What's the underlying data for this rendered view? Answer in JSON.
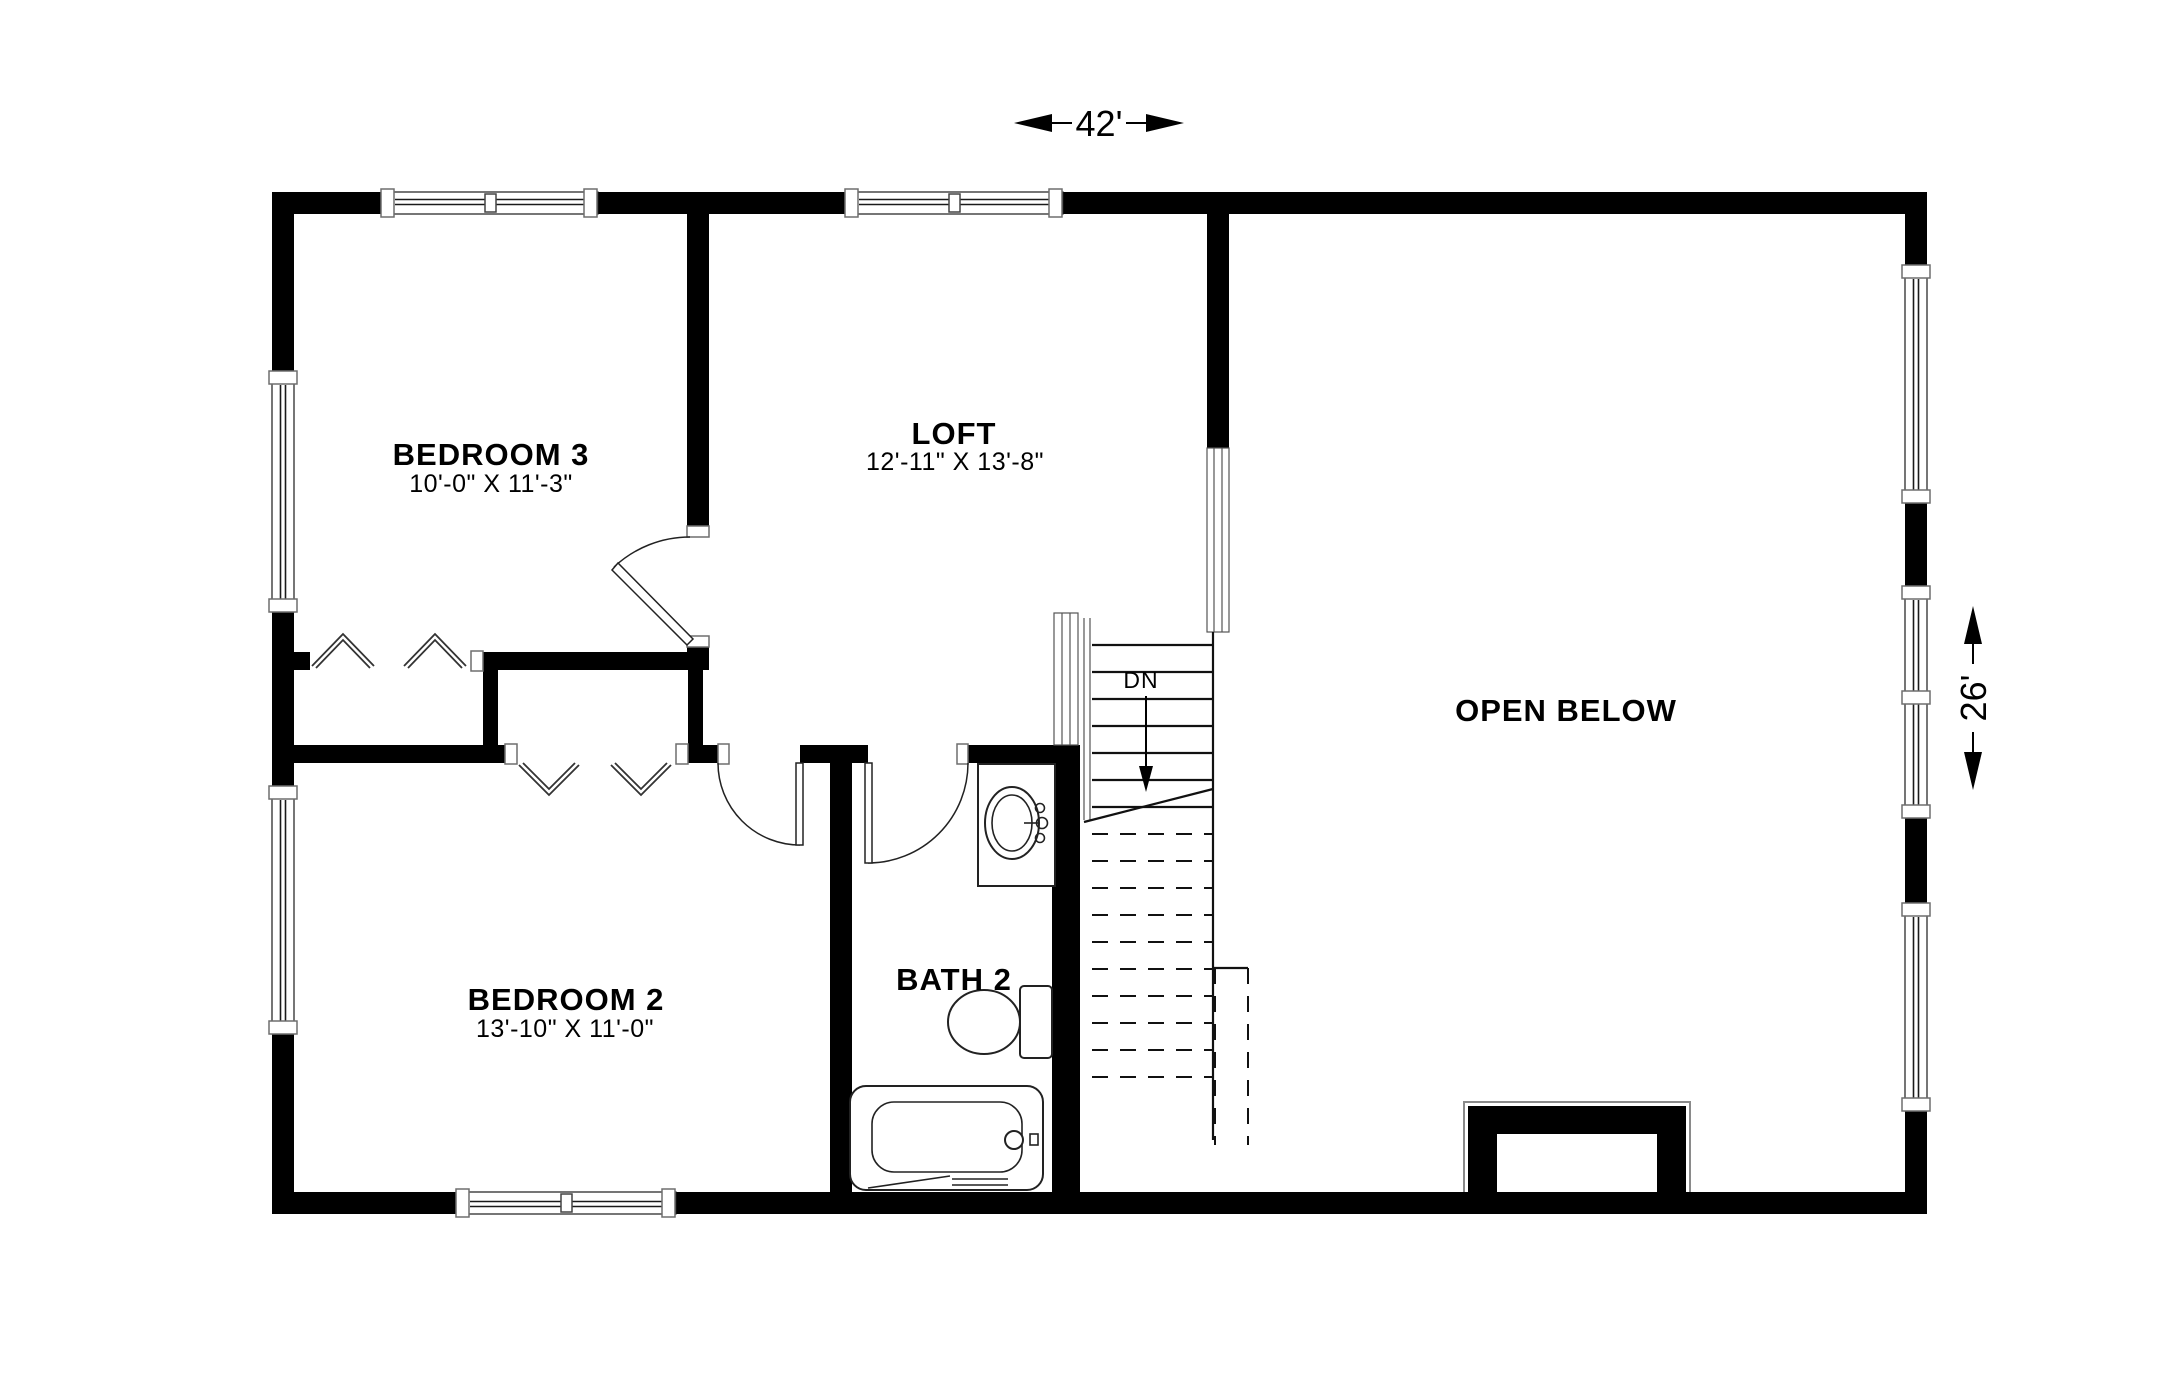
{
  "title": "Second floor plan",
  "dimensions": {
    "width_label": "42'",
    "height_label": "26'"
  },
  "rooms": {
    "bedroom3": {
      "name": "BEDROOM 3",
      "size": "10'-0\" X 11'-3\""
    },
    "loft": {
      "name": "LOFT",
      "size": "12'-11\" X 13'-8\""
    },
    "bedroom2": {
      "name": "BEDROOM 2",
      "size": "13'-10\" X 11'-0\""
    },
    "bath2": {
      "name": "BATH 2"
    },
    "open_below": {
      "name": "OPEN BELOW"
    }
  },
  "stairs": {
    "direction_label": "DN"
  },
  "fixtures": [
    "vanity-sink",
    "toilet",
    "bathtub",
    "fireplace-chase"
  ],
  "colors": {
    "wall": "#000000",
    "line": "#1a1a1a",
    "background": "#ffffff"
  }
}
